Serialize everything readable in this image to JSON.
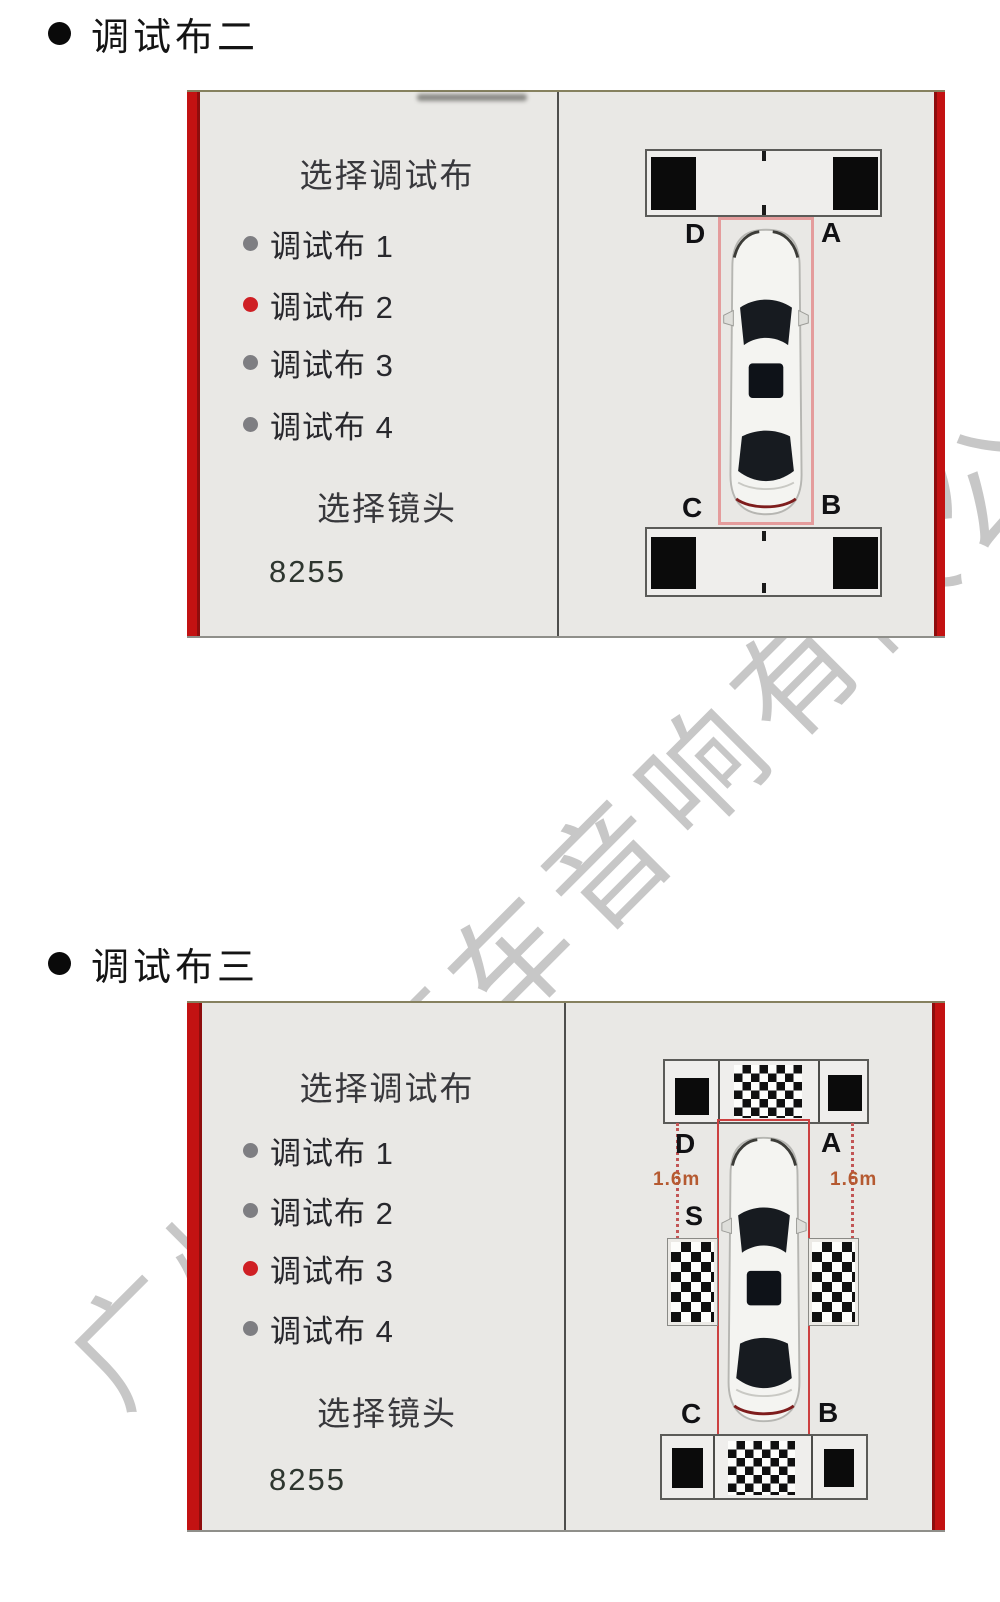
{
  "watermark": {
    "text": "广州市汽车音响有限公司",
    "color": "#c7c7c7"
  },
  "colors": {
    "frame_red": "#c31212",
    "panel_bg": "#e9e8e5",
    "radio_selected": "#cf1f24",
    "radio_unselected": "#7e7e82",
    "car_zone_border_1": "#e49c9c",
    "car_zone_border_2": "#cc4040",
    "distance_text": "#b55a31"
  },
  "sections": [
    {
      "heading": "调试布二",
      "panel": {
        "title": "选择调试布",
        "options": [
          {
            "label": "调试布 1",
            "selected": false
          },
          {
            "label": "调试布 2",
            "selected": true
          },
          {
            "label": "调试布 3",
            "selected": false
          },
          {
            "label": "调试布 4",
            "selected": false
          }
        ],
        "lens_title": "选择镜头",
        "lens_value": "8255"
      },
      "diagram": {
        "corner_top_left": "D",
        "corner_top_right": "A",
        "corner_bottom_left": "C",
        "corner_bottom_right": "B"
      }
    },
    {
      "heading": "调试布三",
      "panel": {
        "title": "选择调试布",
        "options": [
          {
            "label": "调试布 1",
            "selected": false
          },
          {
            "label": "调试布 2",
            "selected": false
          },
          {
            "label": "调试布 3",
            "selected": true
          },
          {
            "label": "调试布 4",
            "selected": false
          }
        ],
        "lens_title": "选择镜头",
        "lens_value": "8255"
      },
      "diagram": {
        "corner_top_left": "D",
        "corner_top_right": "A",
        "corner_bottom_left": "C",
        "corner_bottom_right": "B",
        "distance_left": "1.6m",
        "distance_right": "1.6m",
        "side_label": "S"
      }
    }
  ]
}
